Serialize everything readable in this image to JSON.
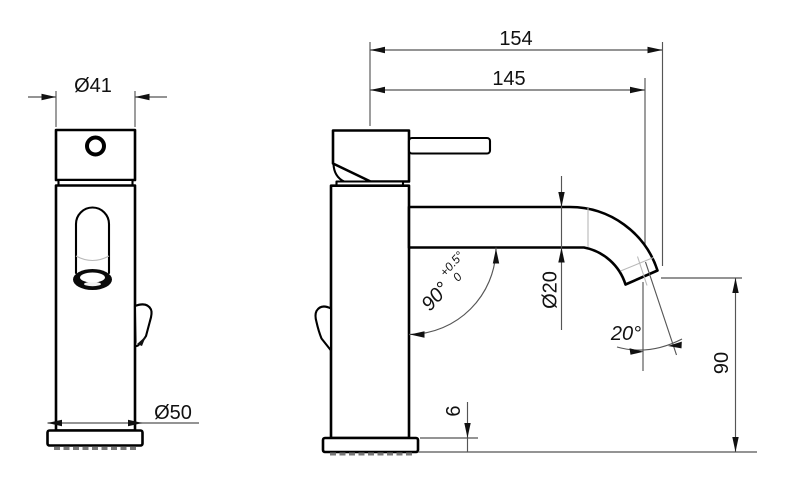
{
  "drawing": {
    "kind": "basin-mixer-tap-dimension-drawing",
    "front": {
      "dims": {
        "top_diameter": "Ø41",
        "base_diameter": "Ø50"
      }
    },
    "side": {
      "dims": {
        "total_reach": "154",
        "spout_reach": "145",
        "spout_diameter": "Ø20",
        "spout_height": "90",
        "base_plate_height": "6",
        "body_spout_angle": "90°",
        "body_spout_angle_tol_upper": "+0.5°",
        "body_spout_angle_tol_lower": "0",
        "outlet_angle": "20°"
      }
    },
    "colors": {
      "background": "#ffffff",
      "outline": "#000000",
      "dimension_line": "#555555",
      "faint_line": "#b9b9b9",
      "text": "#111111"
    }
  }
}
